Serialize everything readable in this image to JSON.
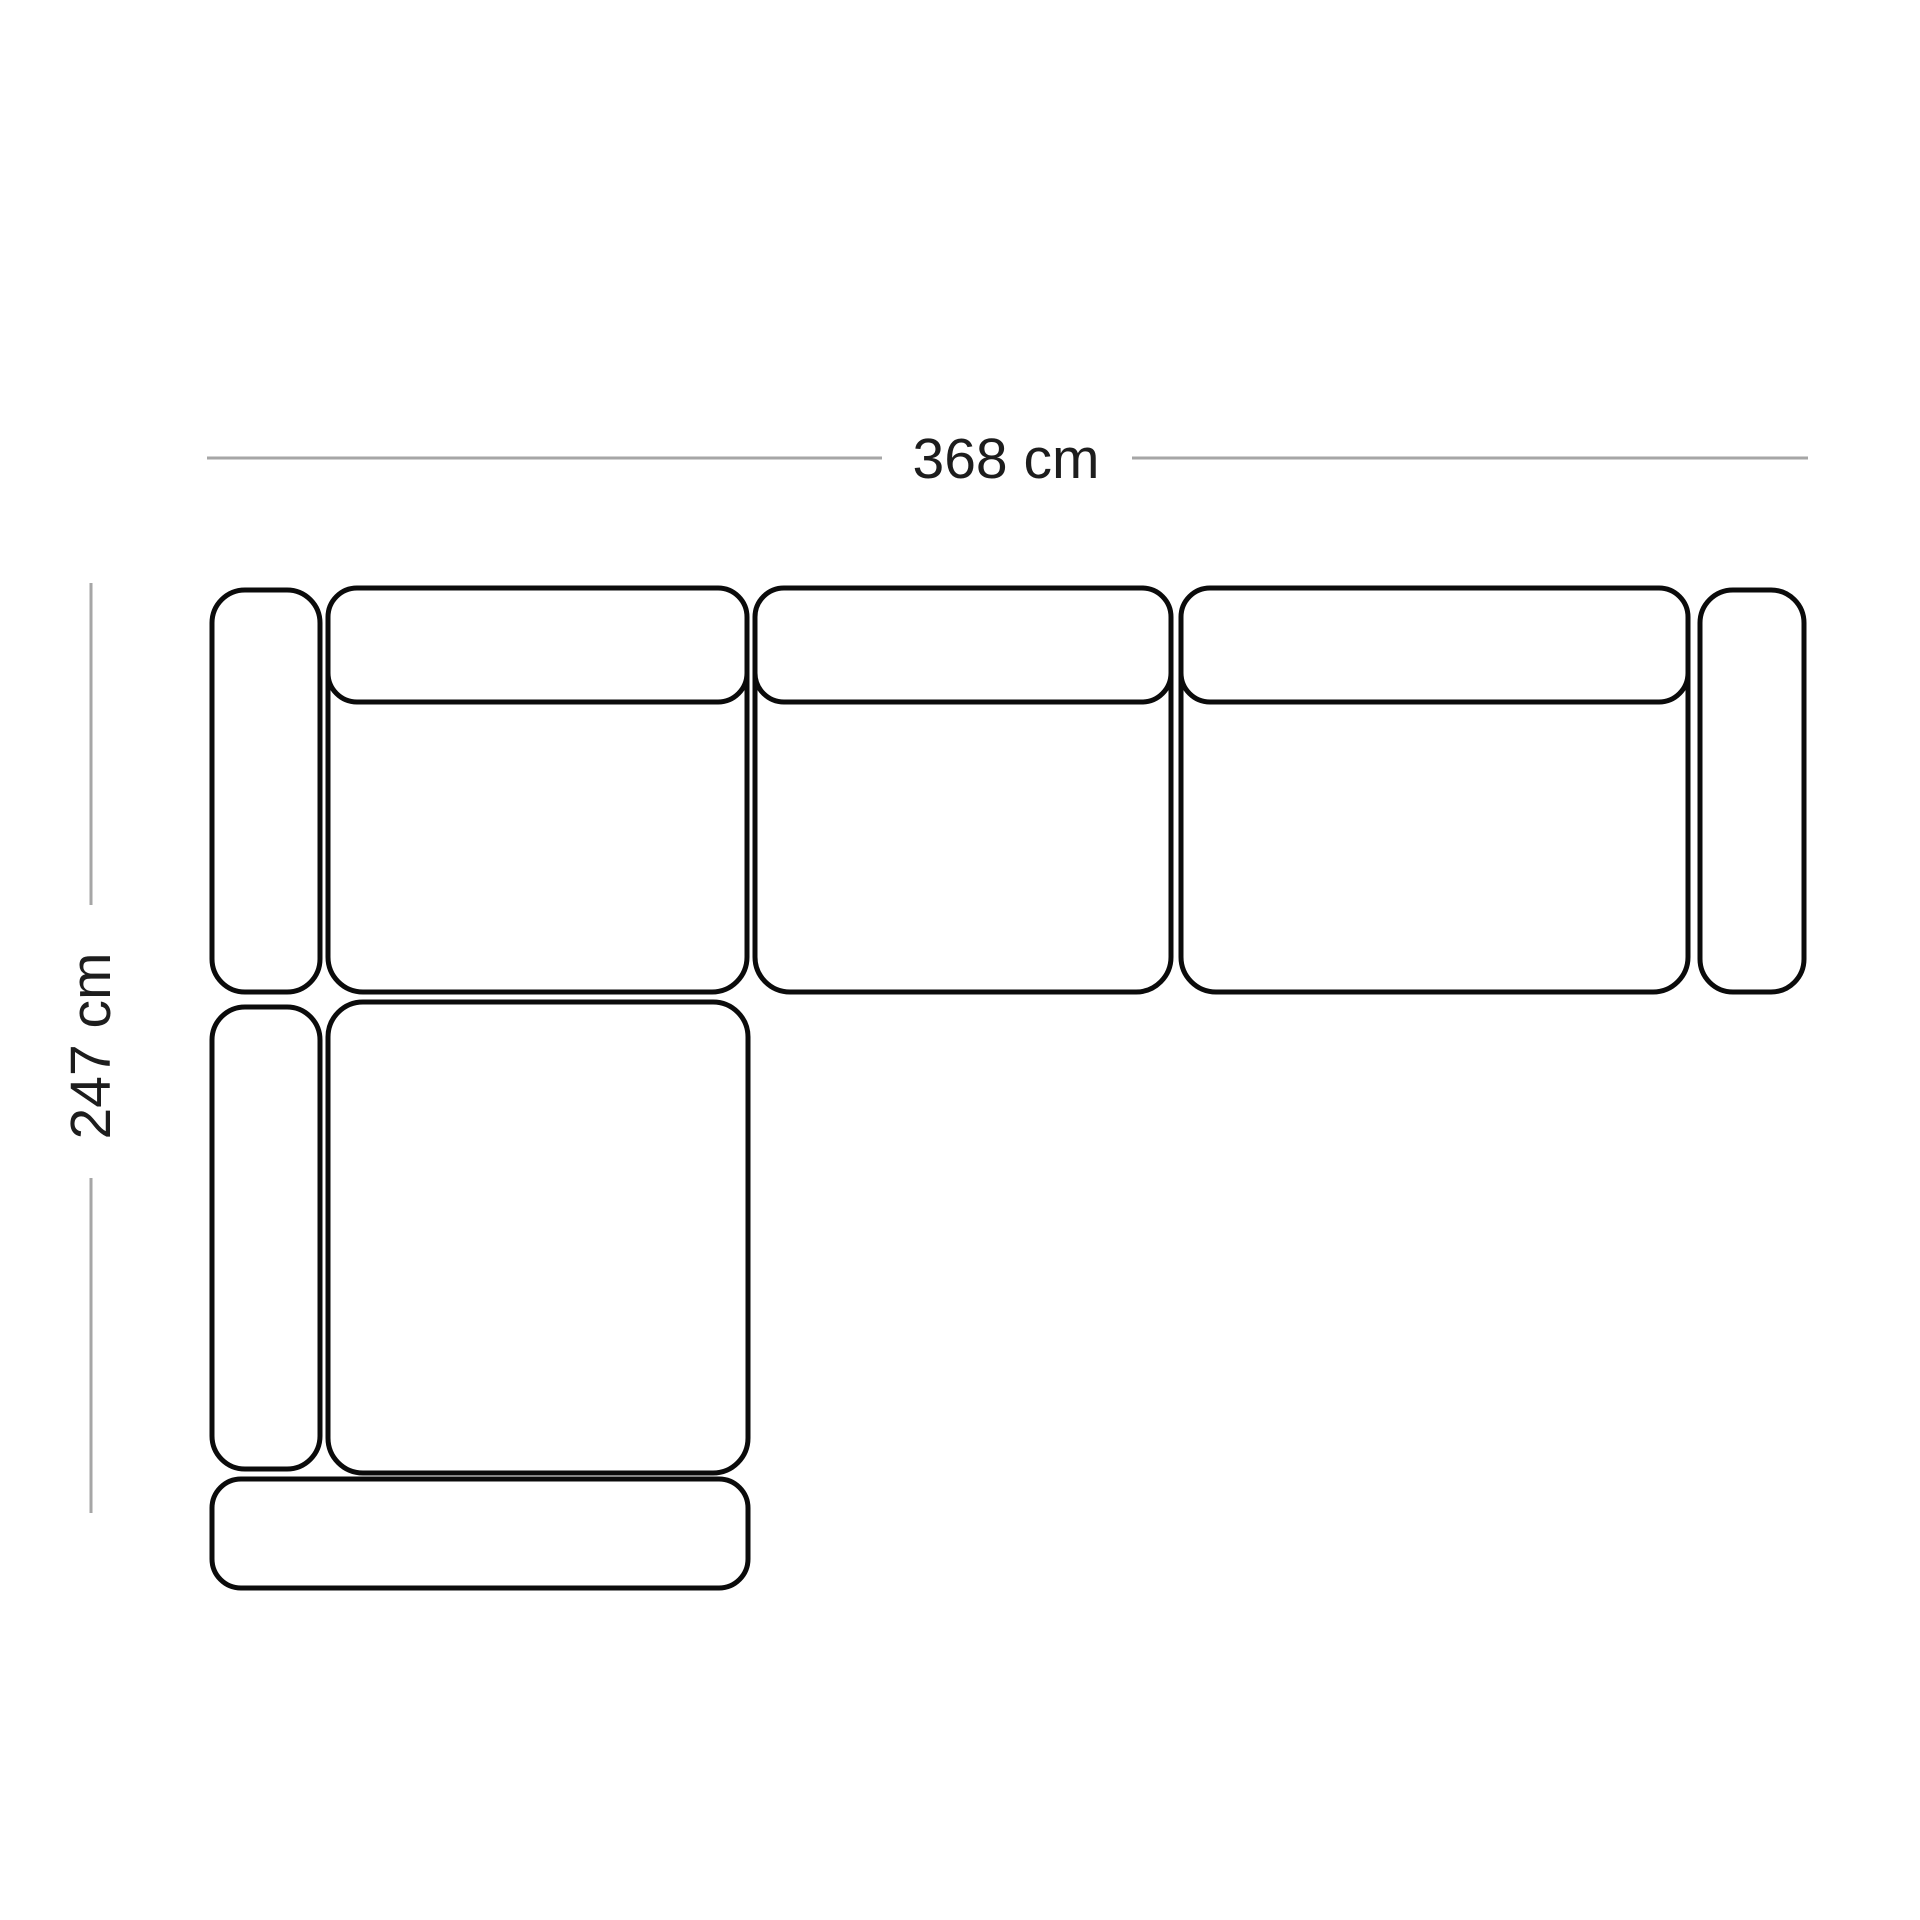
{
  "diagram": {
    "width_label": "368 cm",
    "depth_label": "247 cm",
    "colors": {
      "background": "#ffffff",
      "outline": "#0b0b0b",
      "dimension_line": "#a6a6a6",
      "label_text": "#1d1d1d"
    }
  }
}
